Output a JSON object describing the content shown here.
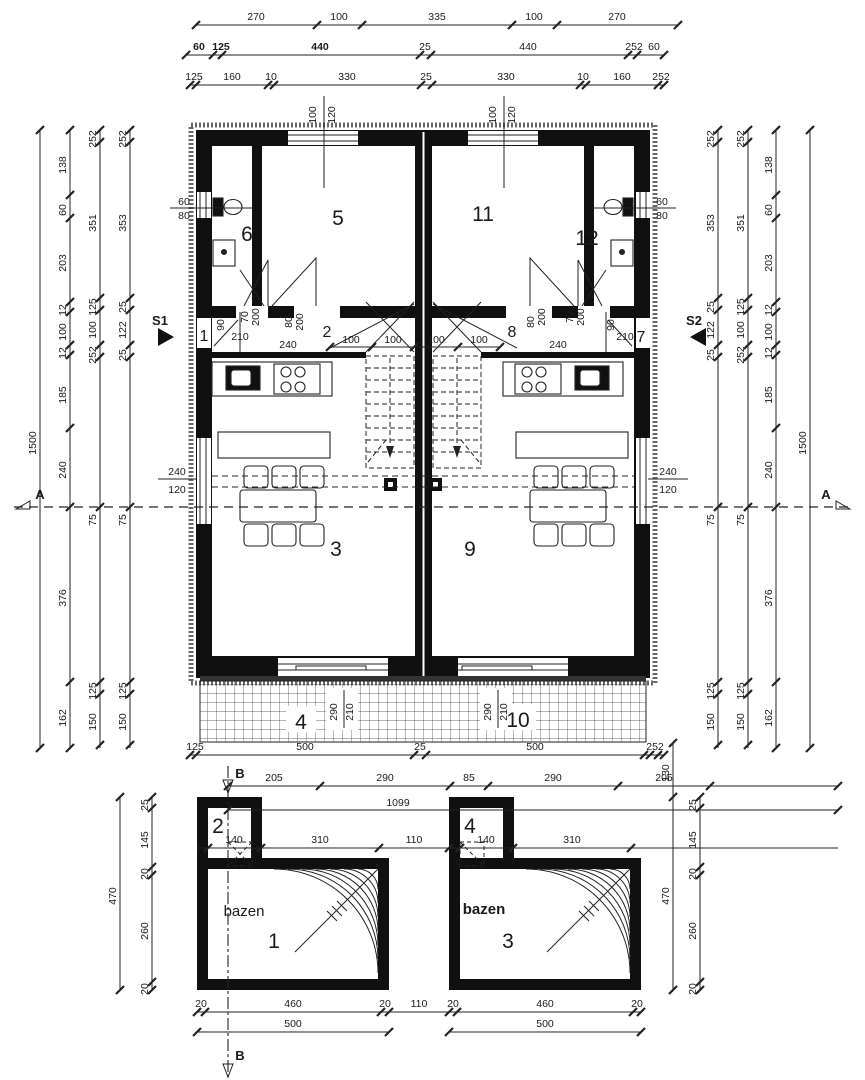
{
  "drawing": {
    "type": "architectural floor plan, duplex house with two pools",
    "colors": {
      "line": "#222222",
      "wall": "#101010",
      "background": "#ffffff",
      "text": "#1a1a1a"
    }
  },
  "dims": {
    "top1": [
      "270",
      "100",
      "335",
      "100",
      "270"
    ],
    "top2": [
      "60",
      "125",
      "440",
      "25",
      "440",
      "252",
      "60"
    ],
    "top3": [
      "125",
      "160",
      "10",
      "330",
      "25",
      "330",
      "10",
      "160",
      "252"
    ],
    "left1": "1500",
    "left2": [
      "138",
      "60",
      "203",
      "12",
      "100",
      "12",
      "185",
      "240",
      "376",
      "162"
    ],
    "left3": [
      "252",
      "351",
      "125",
      "100",
      "252",
      "75",
      "125",
      "150"
    ],
    "left4": [
      "252",
      "353",
      "25",
      "122",
      "25",
      "75",
      "125",
      "150"
    ],
    "right1": "1500",
    "right2": [
      "138",
      "60",
      "203",
      "12",
      "100",
      "12",
      "185",
      "240",
      "376",
      "162"
    ],
    "right3": [
      "252",
      "351",
      "125",
      "100",
      "252",
      "75",
      "125",
      "150"
    ],
    "right4": [
      "252",
      "353",
      "25",
      "122",
      "25",
      "75",
      "125",
      "150"
    ],
    "bottom1": [
      "125",
      "500",
      "25",
      "500",
      "252"
    ],
    "bottom2": [
      "205",
      "290",
      "85",
      "290",
      "205"
    ],
    "total": "1099",
    "stair": [
      "100",
      "100",
      "100",
      "100"
    ],
    "pooltop": [
      "140",
      "310",
      "110",
      "140",
      "310"
    ],
    "poolleft1": "470",
    "poolleft2": [
      "25",
      "145",
      "20",
      "260",
      "20"
    ],
    "poolright1": [
      "130",
      "470"
    ],
    "poolright2": [
      "25",
      "145",
      "20",
      "260",
      "20"
    ],
    "poolbottom1": [
      "20",
      "460",
      "20",
      "110",
      "20",
      "460",
      "20"
    ],
    "poolbottom2": [
      "500",
      "500"
    ],
    "winTopL": [
      "100",
      "120"
    ],
    "winTopR": [
      "100",
      "120"
    ],
    "winSideL": [
      "60",
      "80"
    ],
    "winSideR": [
      "60",
      "80"
    ],
    "winLivL": [
      "240",
      "120"
    ],
    "winLivR": [
      "240",
      "120"
    ],
    "doorL": [
      "90",
      "210",
      "70",
      "200",
      "80",
      "200",
      "240"
    ],
    "doorR": [
      "80",
      "200",
      "70",
      "200",
      "90",
      "210",
      "240"
    ],
    "terrL": [
      "290",
      "210"
    ],
    "terrR": [
      "290",
      "210"
    ]
  },
  "rooms": {
    "n1": "1",
    "n2": "2",
    "n3": "3",
    "n4": "4",
    "n5": "5",
    "n6": "6",
    "n7": "7",
    "n8": "8",
    "n9": "9",
    "n10": "10",
    "n11": "11",
    "n12": "12"
  },
  "pools": {
    "bazenL": "bazen",
    "bazenR": "bazen",
    "roomL": "2",
    "roomR": "4",
    "p1": "1",
    "p3": "3"
  },
  "sections": {
    "s1": "S1",
    "s2": "S2",
    "aL": "A",
    "aR": "A",
    "bTop": "B",
    "bBot": "B"
  }
}
